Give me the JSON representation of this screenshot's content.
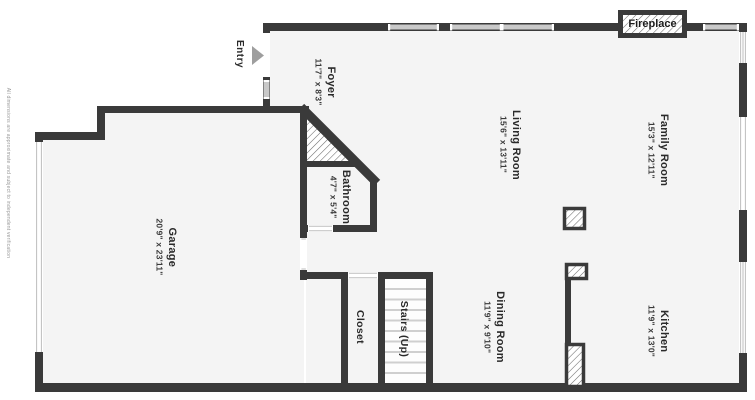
{
  "disclaimer": "All dimensions are approximate and subject to independent verification",
  "entry": {
    "label": "Entry"
  },
  "fireplace": {
    "label": "Fireplace"
  },
  "rooms": {
    "foyer": {
      "name": "Foyer",
      "dims": "11'7\" x 8'3\""
    },
    "living_room": {
      "name": "Living Room",
      "dims": "15'6\" x 13'11\""
    },
    "family_room": {
      "name": "Family Room",
      "dims": "15'3\" x 12'11\""
    },
    "bathroom": {
      "name": "Bathroom",
      "dims": "4'7\" x 5'4\""
    },
    "garage": {
      "name": "Garage",
      "dims": "20'9\" x 23'11\""
    },
    "dining_room": {
      "name": "Dining Room",
      "dims": "11'9\" x 9'10\""
    },
    "kitchen": {
      "name": "Kitchen",
      "dims": "11'9\" x 13'0\""
    },
    "closet": {
      "name": "Closet"
    },
    "stairs": {
      "name": "Stairs (Up)"
    }
  },
  "colors": {
    "wall": "#3a3a3a",
    "room_fill": "#f4f4f4",
    "window_fill": "#c9c9c9",
    "stair_tread": "#cfcfcf",
    "entry_arrow": "#9e9e9e",
    "hatch_line": "#6b6b6b",
    "jamb_line": "#bdbdbd"
  }
}
